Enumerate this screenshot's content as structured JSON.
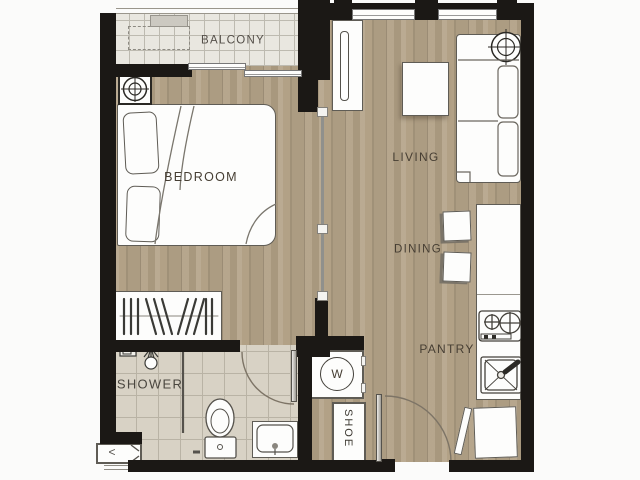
{
  "plan": {
    "rooms": {
      "balcony": {
        "label": "BALCONY"
      },
      "bedroom": {
        "label": "BEDROOM"
      },
      "living": {
        "label": "LIVING"
      },
      "dining": {
        "label": "DINING"
      },
      "pantry": {
        "label": "PANTRY"
      },
      "shower": {
        "label": "SHOWER"
      }
    },
    "fixtures": {
      "washer": {
        "label": "W"
      },
      "shoe_cabinet": {
        "label": "SHOE"
      },
      "ac_ledge": {
        "mark": "<"
      }
    },
    "colors": {
      "wall": "#1b1815",
      "wood_floor": "#b2a186",
      "balcony_tile": "#e9e7e0",
      "bathroom_tile": "#d8d2c5",
      "label_text": "#463e33"
    }
  }
}
